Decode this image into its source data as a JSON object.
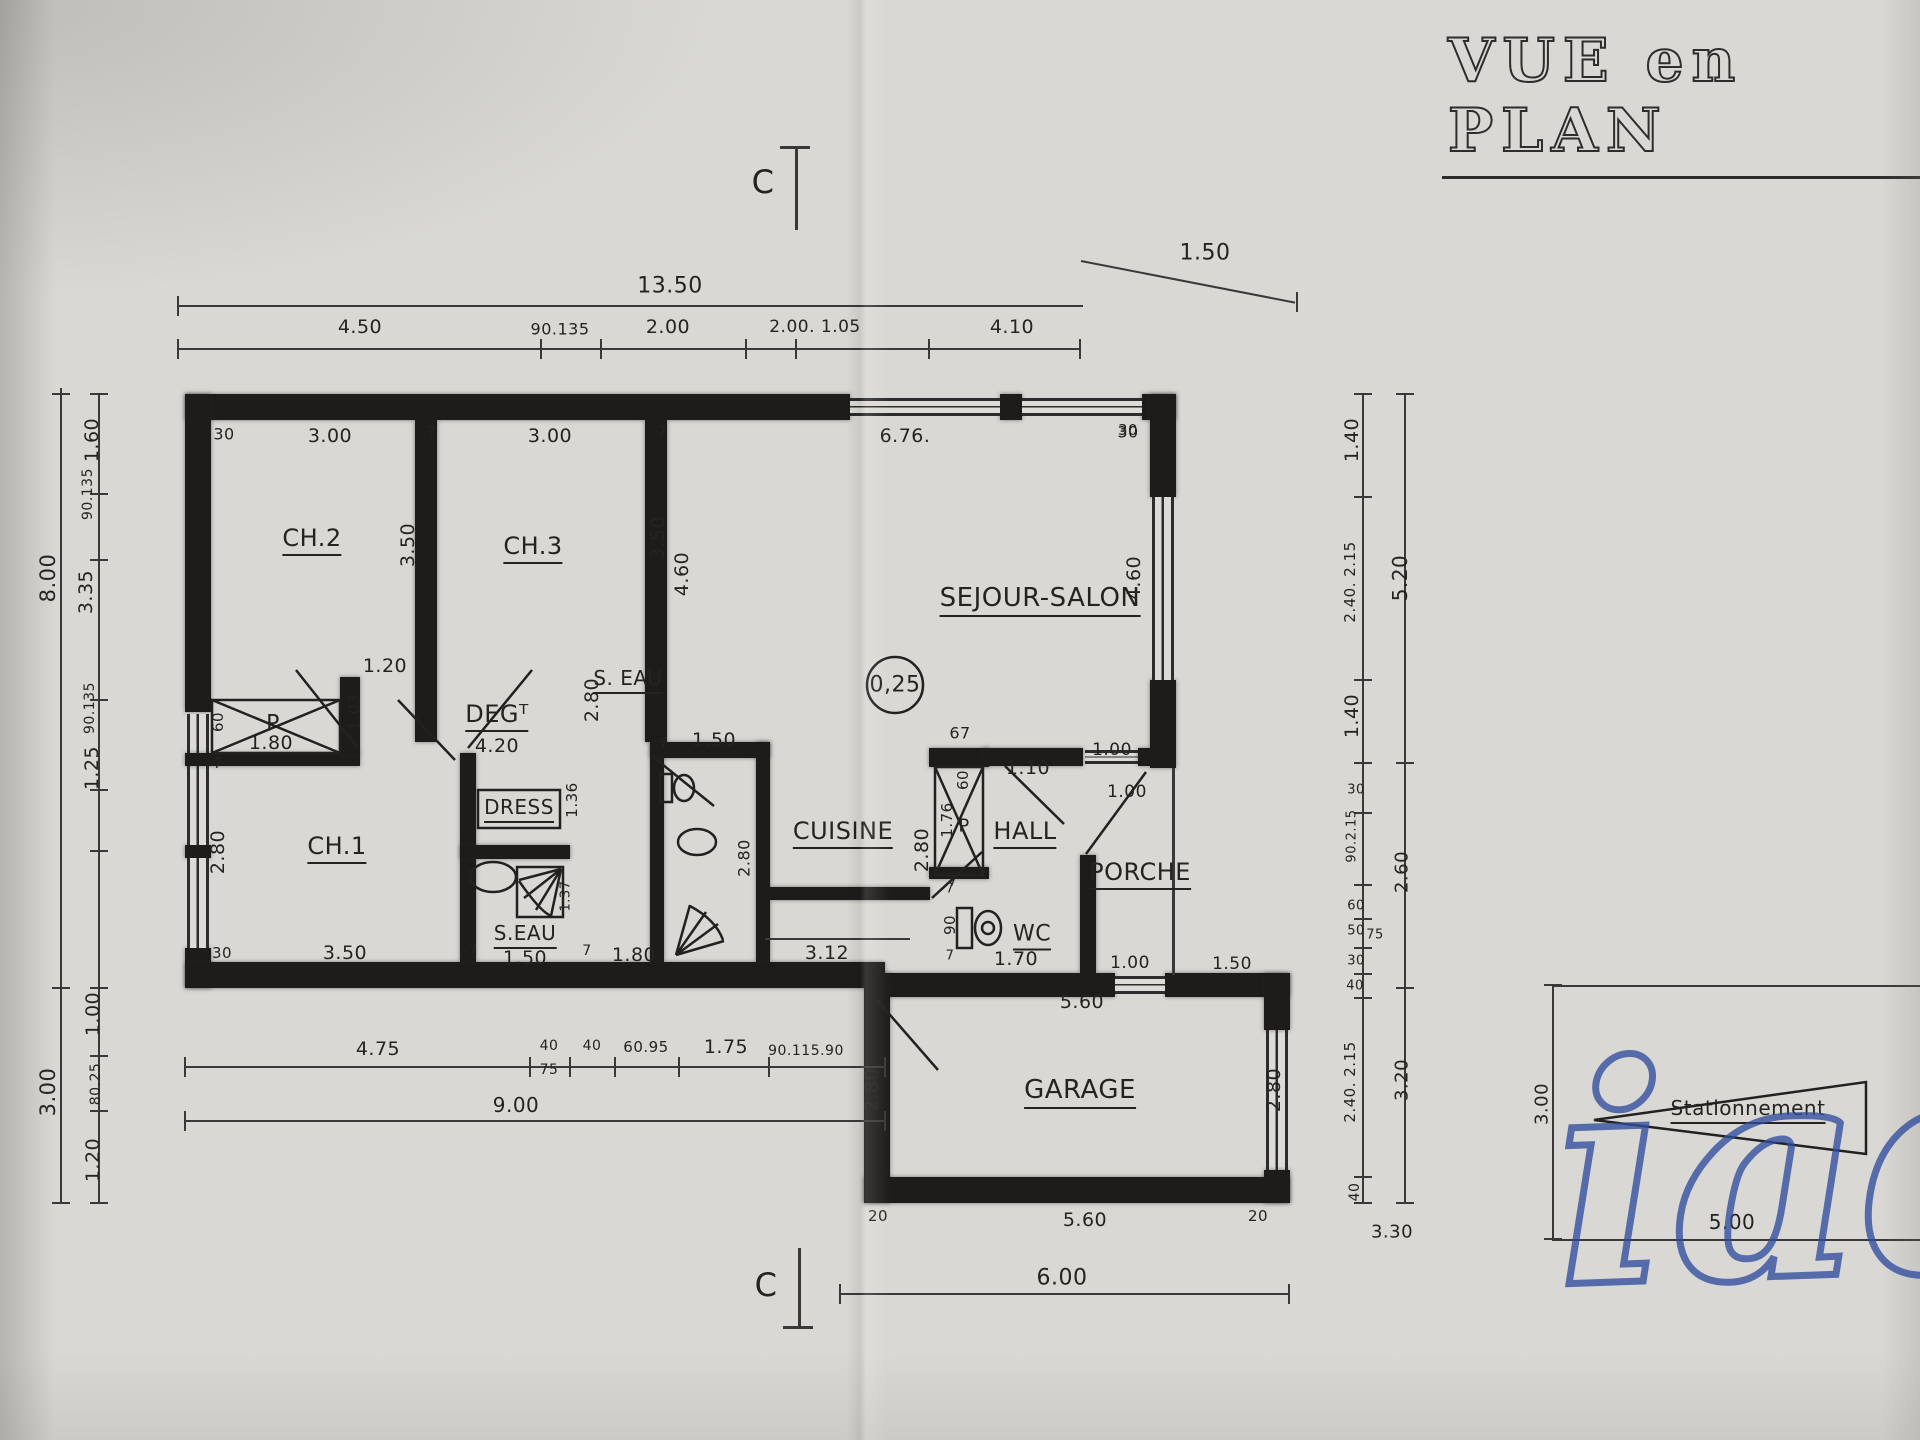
{
  "page": {
    "title": "VUE en PLAN",
    "watermark": "iad"
  },
  "colors": {
    "ink": "#1d1c1b",
    "paper": "#d9d8d4",
    "watermark_blue": "#314c9c"
  },
  "plan": {
    "section_marker": "C",
    "labels": [
      {
        "n": "section-marker-top",
        "t": "C",
        "x": 763,
        "y": 182,
        "s": 32
      },
      {
        "n": "section-marker-bottom",
        "t": "C",
        "x": 766,
        "y": 1285,
        "s": 32
      },
      {
        "n": "dim-top-total",
        "t": "13.50",
        "x": 670,
        "y": 286,
        "s": 22
      },
      {
        "n": "dim-top-ext",
        "t": "1.50",
        "x": 1205,
        "y": 253,
        "s": 22
      },
      {
        "t": "4.50",
        "x": 360,
        "y": 327
      },
      {
        "t": "90.135",
        "x": 560,
        "y": 329,
        "s": 16
      },
      {
        "t": "2.00",
        "x": 668,
        "y": 327
      },
      {
        "t": "2.00. 1.05",
        "x": 815,
        "y": 327,
        "s": 17
      },
      {
        "t": "4.10",
        "x": 1012,
        "y": 327
      },
      {
        "t": "30",
        "x": 224,
        "y": 434,
        "s": 16
      },
      {
        "t": "3.00",
        "x": 330,
        "y": 436
      },
      {
        "t": "7",
        "x": 432,
        "y": 432,
        "s": 15
      },
      {
        "t": "3.00",
        "x": 550,
        "y": 436
      },
      {
        "t": "7",
        "x": 662,
        "y": 432,
        "s": 15
      },
      {
        "t": "6.76.",
        "x": 905,
        "y": 436
      },
      {
        "t": "30",
        "x": 1128,
        "y": 432,
        "s": 16
      },
      {
        "n": "room-label-ch2",
        "t": "CH.2",
        "x": 312,
        "y": 540,
        "s": 24,
        "u": true
      },
      {
        "n": "room-label-ch3",
        "t": "CH.3",
        "x": 533,
        "y": 548,
        "s": 24,
        "u": true
      },
      {
        "n": "room-label-sejour",
        "t": "SEJOUR-SALON",
        "x": 1040,
        "y": 600,
        "s": 26,
        "u": true
      },
      {
        "n": "ceiling-height",
        "t": "0,25",
        "x": 895,
        "y": 685,
        "s": 22
      },
      {
        "t": "3.50",
        "x": 408,
        "y": 545,
        "r": -90
      },
      {
        "t": "3.50",
        "x": 658,
        "y": 538,
        "r": -90
      },
      {
        "t": "4.60",
        "x": 682,
        "y": 574,
        "r": -90
      },
      {
        "t": "1.20",
        "x": 385,
        "y": 666
      },
      {
        "t": "1.03",
        "x": 354,
        "y": 712,
        "r": -90,
        "s": 16
      },
      {
        "t": "7",
        "x": 350,
        "y": 742,
        "s": 14
      },
      {
        "t": "60",
        "x": 218,
        "y": 722,
        "r": -90,
        "s": 15
      },
      {
        "n": "closet-label",
        "t": "P",
        "x": 273,
        "y": 724,
        "s": 22
      },
      {
        "t": "1.80",
        "x": 271,
        "y": 743
      },
      {
        "t": "7",
        "x": 218,
        "y": 764,
        "s": 14
      },
      {
        "n": "room-label-deg",
        "t": "DEGᵀ",
        "x": 497,
        "y": 716,
        "s": 24,
        "u": true
      },
      {
        "t": "4.20",
        "x": 497,
        "y": 746
      },
      {
        "n": "room-label-dress",
        "t": "DRESS",
        "x": 519,
        "y": 809,
        "s": 20,
        "u": true
      },
      {
        "t": "1.36",
        "x": 572,
        "y": 800,
        "r": -90,
        "s": 15
      },
      {
        "n": "room-label-ch1",
        "t": "CH.1",
        "x": 337,
        "y": 848,
        "s": 24,
        "u": true
      },
      {
        "t": "2.80",
        "x": 218,
        "y": 852,
        "r": -90
      },
      {
        "t": "30",
        "x": 222,
        "y": 953,
        "s": 15
      },
      {
        "t": "3.50",
        "x": 345,
        "y": 953
      },
      {
        "t": "7",
        "x": 473,
        "y": 951,
        "s": 14
      },
      {
        "n": "room-label-seau1",
        "t": "S.EAU",
        "x": 525,
        "y": 935,
        "s": 20,
        "u": true
      },
      {
        "t": "1.50",
        "x": 525,
        "y": 958
      },
      {
        "t": "7",
        "x": 587,
        "y": 951,
        "s": 14
      },
      {
        "t": "1.80",
        "x": 634,
        "y": 955
      },
      {
        "t": "1.37",
        "x": 566,
        "y": 896,
        "r": -90,
        "s": 13
      },
      {
        "n": "room-label-seau2",
        "t": "S. EAU",
        "x": 628,
        "y": 680,
        "s": 20,
        "u": true
      },
      {
        "t": "2.80",
        "x": 592,
        "y": 700,
        "r": -90
      },
      {
        "t": "7",
        "x": 664,
        "y": 744,
        "s": 14
      },
      {
        "t": "1.50",
        "x": 714,
        "y": 740
      },
      {
        "t": "2.80",
        "x": 744,
        "y": 858,
        "r": -90,
        "s": 16
      },
      {
        "n": "room-label-cuisine",
        "t": "CUISINE",
        "x": 843,
        "y": 833,
        "s": 24,
        "u": true
      },
      {
        "t": "3.12",
        "x": 827,
        "y": 953
      },
      {
        "t": "67",
        "x": 960,
        "y": 733,
        "s": 16
      },
      {
        "t": "60",
        "x": 963,
        "y": 780,
        "r": -90,
        "s": 15
      },
      {
        "t": "1.76",
        "x": 947,
        "y": 820,
        "r": -90,
        "s": 15
      },
      {
        "n": "closet-label",
        "t": "P",
        "x": 964,
        "y": 826,
        "s": 18
      },
      {
        "t": "2.80",
        "x": 922,
        "y": 850,
        "r": -90
      },
      {
        "t": "7",
        "x": 953,
        "y": 882,
        "s": 14
      },
      {
        "n": "room-label-hall",
        "t": "HALL",
        "x": 1025,
        "y": 833,
        "s": 24,
        "u": true
      },
      {
        "t": "1.10",
        "x": 1028,
        "y": 768
      },
      {
        "t": "1.00",
        "x": 1112,
        "y": 750,
        "s": 17
      },
      {
        "t": "1.00",
        "x": 1127,
        "y": 792,
        "s": 17
      },
      {
        "n": "room-label-porche",
        "t": "PORCHE",
        "x": 1140,
        "y": 874,
        "s": 24,
        "u": true
      },
      {
        "t": "1.00",
        "x": 1130,
        "y": 963,
        "s": 17
      },
      {
        "t": "1.50",
        "x": 1232,
        "y": 964,
        "s": 17
      },
      {
        "t": "30",
        "x": 1128,
        "y": 430,
        "s": 15
      },
      {
        "t": "4.60",
        "x": 1134,
        "y": 578,
        "r": -90
      },
      {
        "t": "90",
        "x": 950,
        "y": 925,
        "r": -90,
        "s": 15
      },
      {
        "t": "7",
        "x": 950,
        "y": 889,
        "s": 13
      },
      {
        "t": "7",
        "x": 950,
        "y": 956,
        "s": 13
      },
      {
        "n": "room-label-wc",
        "t": "WC",
        "x": 1032,
        "y": 936,
        "s": 22,
        "u": true
      },
      {
        "t": "1.70",
        "x": 1016,
        "y": 959
      },
      {
        "t": "5.60",
        "x": 1082,
        "y": 1002
      },
      {
        "n": "room-label-garage",
        "t": "GARAGE",
        "x": 1080,
        "y": 1092,
        "s": 26,
        "u": true
      },
      {
        "t": "2.80",
        "x": 872,
        "y": 1090,
        "r": -90
      },
      {
        "t": "2.80",
        "x": 1274,
        "y": 1090,
        "r": -90
      },
      {
        "t": "20",
        "x": 878,
        "y": 1216,
        "s": 15
      },
      {
        "t": "5.60",
        "x": 1085,
        "y": 1220
      },
      {
        "t": "20",
        "x": 1258,
        "y": 1216,
        "s": 15
      },
      {
        "t": "6.00",
        "x": 1062,
        "y": 1278,
        "s": 22
      },
      {
        "t": "4.75",
        "x": 378,
        "y": 1049
      },
      {
        "t": "40",
        "x": 549,
        "y": 1046,
        "s": 14
      },
      {
        "t": "75",
        "x": 549,
        "y": 1070,
        "s": 14
      },
      {
        "t": "40",
        "x": 592,
        "y": 1046,
        "s": 14
      },
      {
        "t": "60.95",
        "x": 646,
        "y": 1047,
        "s": 15
      },
      {
        "t": "1.75",
        "x": 726,
        "y": 1047
      },
      {
        "t": "90.115.90",
        "x": 806,
        "y": 1051,
        "s": 14
      },
      {
        "t": "9.00",
        "x": 516,
        "y": 1105,
        "s": 20
      },
      {
        "t": "1.60",
        "x": 92,
        "y": 440,
        "r": -90
      },
      {
        "t": "90.135",
        "x": 88,
        "y": 494,
        "r": -90,
        "s": 14
      },
      {
        "t": "3.35",
        "x": 86,
        "y": 592,
        "r": -90
      },
      {
        "t": "90.135",
        "x": 90,
        "y": 708,
        "r": -90,
        "s": 14
      },
      {
        "t": "1.25",
        "x": 92,
        "y": 768,
        "r": -90
      },
      {
        "t": "1.00",
        "x": 93,
        "y": 1014,
        "r": -90
      },
      {
        "t": "80.25",
        "x": 96,
        "y": 1084,
        "r": -90,
        "s": 14
      },
      {
        "t": "1.20",
        "x": 93,
        "y": 1160,
        "r": -90
      },
      {
        "t": "8.00",
        "x": 48,
        "y": 578,
        "r": -90,
        "s": 21
      },
      {
        "t": "3.00",
        "x": 48,
        "y": 1092,
        "r": -90,
        "s": 21
      },
      {
        "t": "1.40",
        "x": 1352,
        "y": 440,
        "r": -90
      },
      {
        "t": "2.40. 2.15",
        "x": 1350,
        "y": 582,
        "r": -90,
        "s": 15
      },
      {
        "t": "1.40",
        "x": 1352,
        "y": 716,
        "r": -90
      },
      {
        "t": "30",
        "x": 1356,
        "y": 790,
        "s": 13
      },
      {
        "t": "90.2.15",
        "x": 1352,
        "y": 836,
        "r": -90,
        "s": 13
      },
      {
        "t": "60",
        "x": 1356,
        "y": 906,
        "s": 13
      },
      {
        "t": "50",
        "x": 1356,
        "y": 931,
        "s": 13
      },
      {
        "t": "75",
        "x": 1375,
        "y": 935,
        "s": 13
      },
      {
        "t": "30",
        "x": 1356,
        "y": 961,
        "s": 13
      },
      {
        "t": "40",
        "x": 1355,
        "y": 986,
        "s": 13
      },
      {
        "t": "2.40. 2.15",
        "x": 1350,
        "y": 1082,
        "r": -90,
        "s": 15
      },
      {
        "t": "40",
        "x": 1355,
        "y": 1192,
        "r": -90,
        "s": 14
      },
      {
        "t": "3.30",
        "x": 1392,
        "y": 1232,
        "s": 18
      },
      {
        "t": "5.20",
        "x": 1400,
        "y": 578,
        "r": -90,
        "s": 20
      },
      {
        "t": "2.60",
        "x": 1402,
        "y": 872,
        "r": -90,
        "s": 18
      },
      {
        "t": "3.20",
        "x": 1402,
        "y": 1080,
        "r": -90,
        "s": 18
      },
      {
        "t": "3.00",
        "x": 1542,
        "y": 1104,
        "r": -90,
        "s": 18
      },
      {
        "n": "parking-label",
        "t": "Stationnement",
        "x": 1748,
        "y": 1110,
        "s": 20,
        "u": true
      },
      {
        "t": "5.00",
        "x": 1732,
        "y": 1222,
        "s": 20
      }
    ]
  }
}
